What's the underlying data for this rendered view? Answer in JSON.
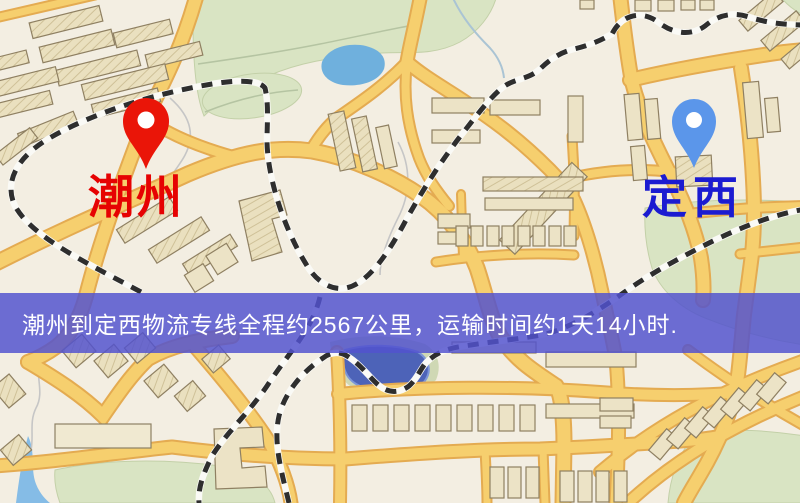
{
  "markers": {
    "origin": {
      "name": "潮州",
      "icon": "map-pin",
      "pin_color": "#ea1508",
      "label_color": "#e60202"
    },
    "destination": {
      "name": "定西",
      "icon": "map-pin",
      "pin_color": "#5b96ea",
      "label_color": "#1b1bd1"
    }
  },
  "banner": {
    "text": "潮州到定西物流专线全程约2567公里，运输时间约1天14小时.",
    "background_color": "#5252ce",
    "text_color": "#ffffff",
    "distance_km": 2567,
    "duration": "1天14小时"
  },
  "map": {
    "colors": {
      "background": "#f3eee2",
      "road_fill": "#f6cf6e",
      "road_casing": "#e4ab51",
      "building_fill": "#ece3c6",
      "building_outline": "#8f8062",
      "park": "#d9e4c3",
      "water_light": "#6fb0dd",
      "water_dark": "#4d63b8",
      "railway_dash": "#2e2e2e"
    }
  }
}
